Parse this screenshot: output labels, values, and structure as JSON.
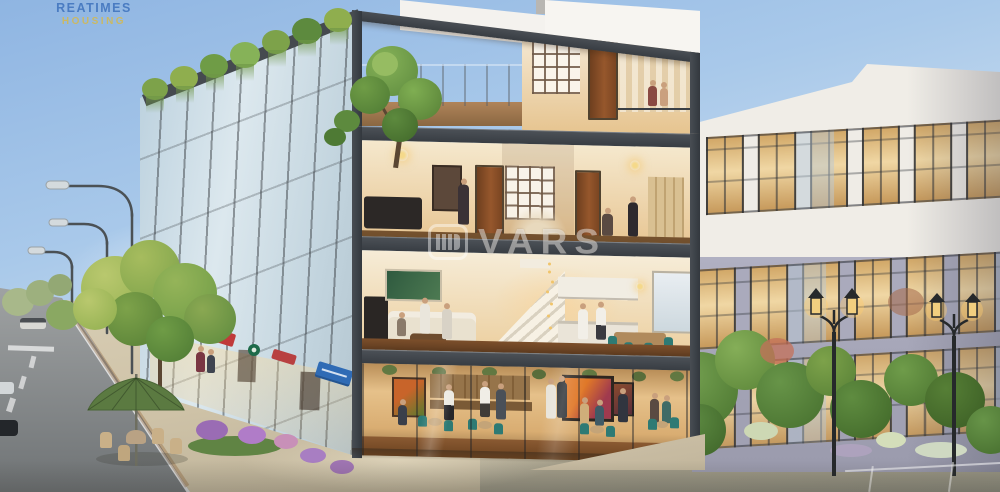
{
  "logo": {
    "line1": "REATIMES",
    "line2": "HOUSING"
  },
  "watermark": {
    "text": "VARS",
    "icon": "vars-bars-logo"
  },
  "scene": {
    "description": "Daytime architectural rendering: corner 4-storey shophouse with cut-away interiors (rooftop terrace, bedrooms, living-dining floor, ground-floor cafe), receding glass shophouse row with rooftop greenery and storefront signs, white apartment building with warm lit windows on the right, street with three highway lamps, trees, sidewalk cafe umbrella and garden lanterns"
  },
  "palette": {
    "sky_top": "#84aede",
    "frame_charcoal": "#41464c",
    "interior_warm": "#f2dcae",
    "wood_floor": "#7c4f2b",
    "teal_chair": "#2e7a74",
    "greenery": "#7da24a",
    "flower_purple": "#a87ec2",
    "right_building_upper": "#f0ede7",
    "right_building_lower": "#a6a6b8",
    "window_glow": "#e7c27c",
    "road_gray": "#8e9192",
    "plaza_beige": "#cfc3aa",
    "umbrella_green": "#5b7a41",
    "sign_blue": "#2f6bb5",
    "sign_red": "#c03a3a",
    "sign_green": "#1e6b4a",
    "logo_blue": "#4a7cc2",
    "logo_yellow": "#d4b94e"
  }
}
